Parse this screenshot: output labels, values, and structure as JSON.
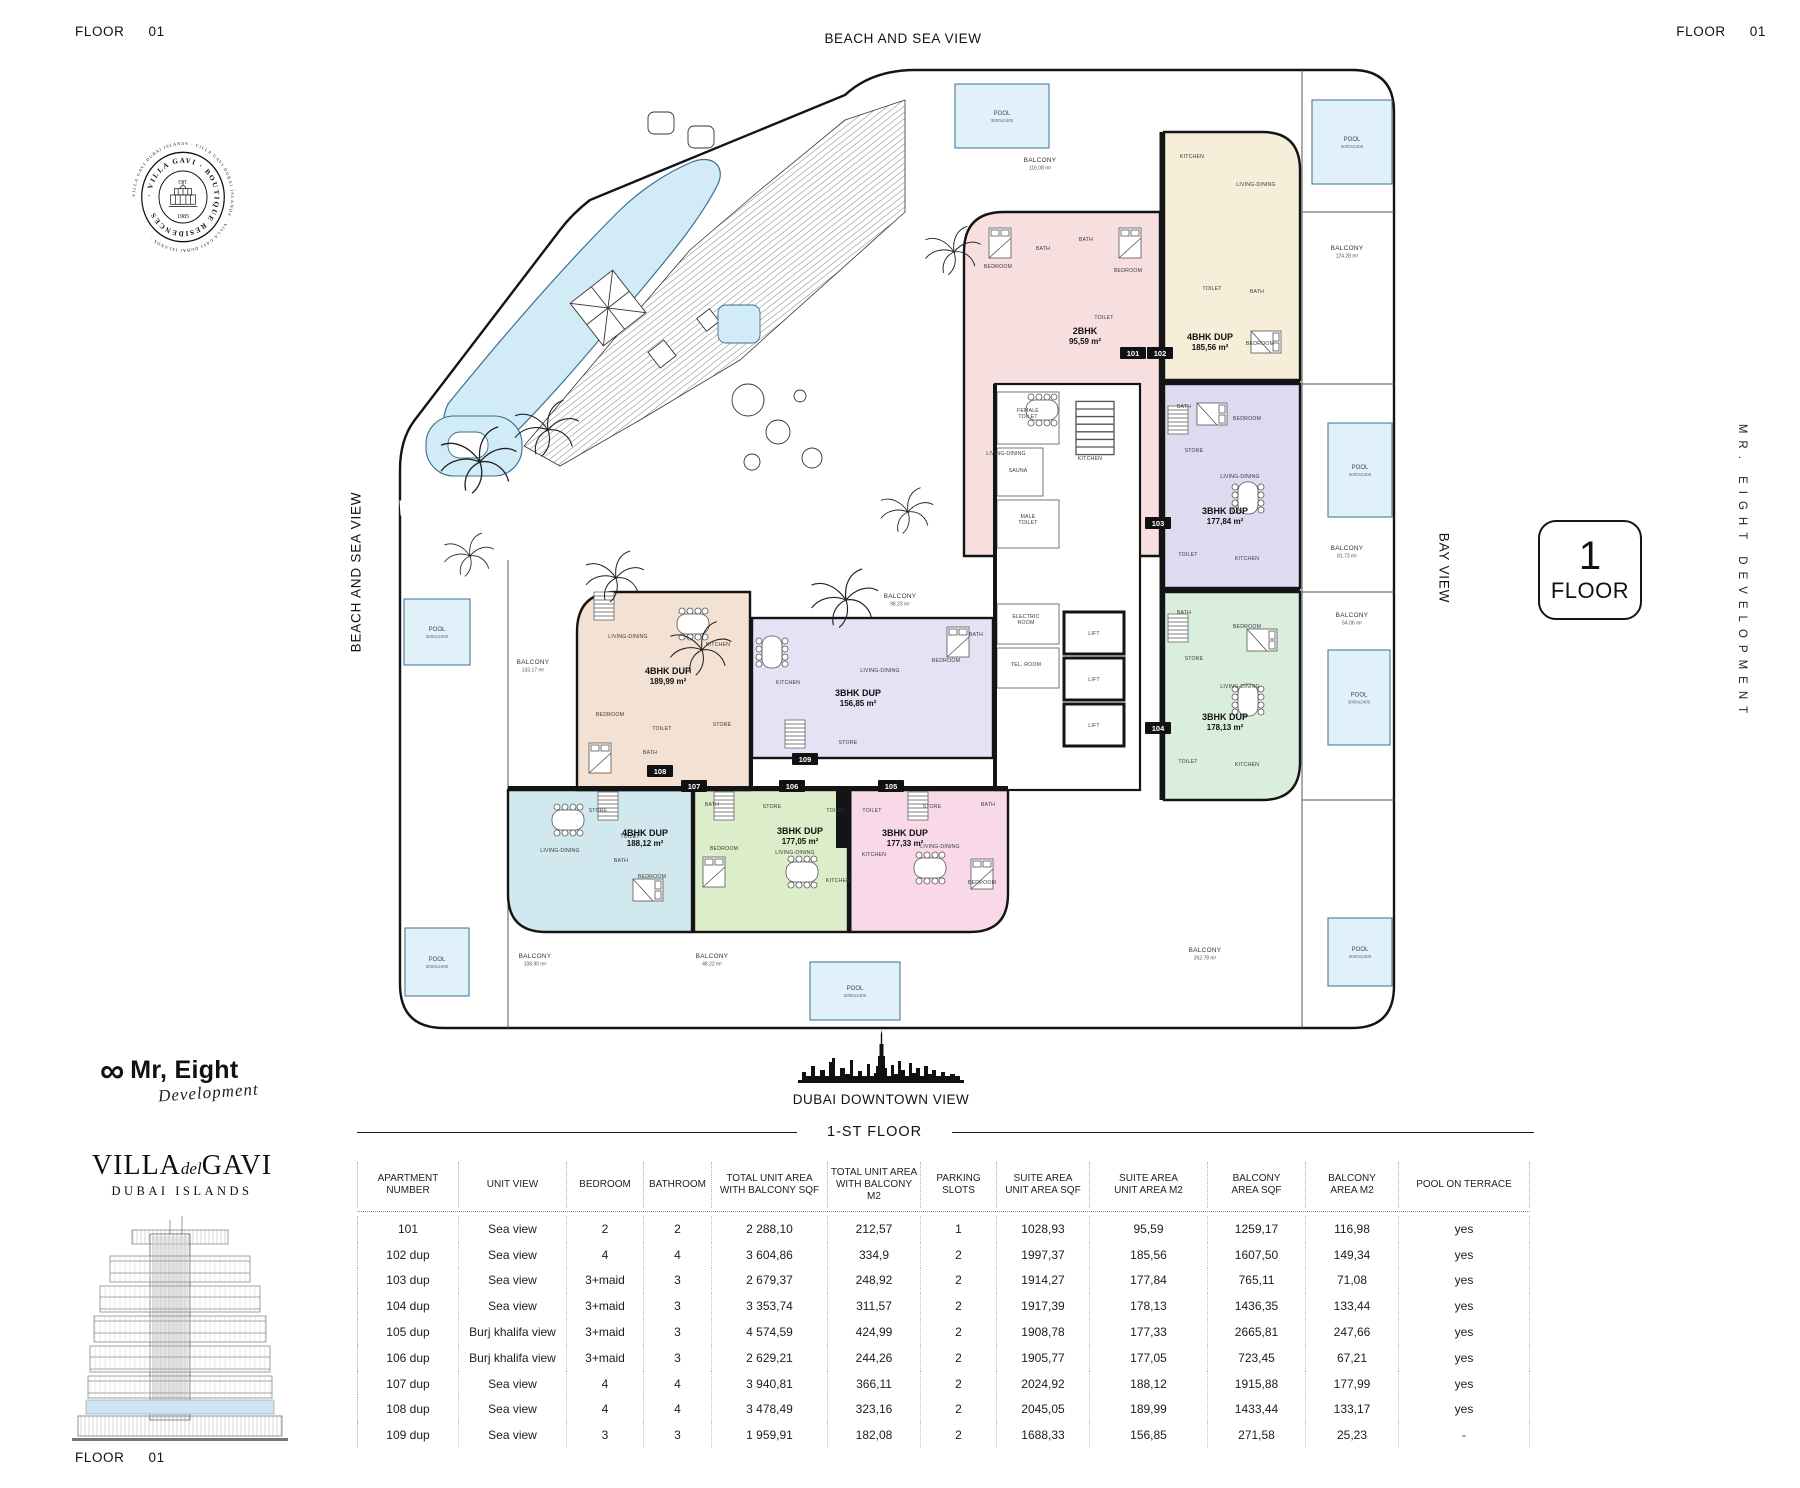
{
  "header": {
    "floor_word": "FLOOR",
    "floor_num": "01",
    "beach_view": "BEACH AND SEA VIEW",
    "bay_view": "BAY VIEW",
    "developer_vertical": "MR. EIGHT DEVELOPMENT",
    "downtown_view": "DUBAI DOWNTOWN VIEW"
  },
  "floor_badge": {
    "number": "1",
    "label": "FLOOR"
  },
  "stamp": {
    "outer_text": "VILLA GAVI DUBAI ISLANDS · VILLA GAVI DUBAI ISLANDS · VILLA GAVI DUBAI ISLANDS · ",
    "ring_text": "· VILLA GAVI ·  BOUTIQUE  RESIDENCES",
    "est": "EST.",
    "year": "1985"
  },
  "logos": {
    "mr_eight": {
      "infinity": "∞",
      "name": "Mr, Eight",
      "script": "Development"
    },
    "villa": {
      "part1": "VILLA",
      "part2": "del",
      "part3": "GAVI",
      "subtitle": "DUBAI ISLANDS"
    }
  },
  "section_title": "1-ST FLOOR",
  "plan": {
    "balcony_word": "BALCONY",
    "pool_word": "POOL",
    "pool_dims": "3000x2400",
    "units": [
      {
        "id": "101",
        "tag": "101",
        "tx": 1133,
        "ty": 353,
        "type": "2BHK",
        "area": "95,59 m²",
        "lx": 1085,
        "ly": 334
      },
      {
        "id": "102",
        "tag": "102",
        "tx": 1160,
        "ty": 353,
        "type": "4BHK DUP",
        "area": "185,56 m²",
        "lx": 1210,
        "ly": 340
      },
      {
        "id": "103",
        "tag": "103",
        "tx": 1158,
        "ty": 523,
        "type": "3BHK DUP",
        "area": "177,84 m²",
        "lx": 1225,
        "ly": 514
      },
      {
        "id": "104",
        "tag": "104",
        "tx": 1158,
        "ty": 728,
        "type": "3BHK DUP",
        "area": "178,13 m²",
        "lx": 1225,
        "ly": 720
      },
      {
        "id": "105",
        "tag": "105",
        "tx": 891,
        "ty": 786,
        "type": "3BHK DUP",
        "area": "177,33 m²",
        "lx": 905,
        "ly": 836
      },
      {
        "id": "106",
        "tag": "106",
        "tx": 792,
        "ty": 786,
        "type": "3BHK DUP",
        "area": "177,05 m²",
        "lx": 800,
        "ly": 834
      },
      {
        "id": "107",
        "tag": "107",
        "tx": 694,
        "ty": 786,
        "type": "4BHK DUP",
        "area": "188,12 m²",
        "lx": 645,
        "ly": 836
      },
      {
        "id": "108",
        "tag": "108",
        "tx": 660,
        "ty": 771,
        "type": "4BHK DUP",
        "area": "189,99 m²",
        "lx": 668,
        "ly": 674
      },
      {
        "id": "109",
        "tag": "109",
        "tx": 805,
        "ty": 759,
        "type": "3BHK DUP",
        "area": "156,85 m²",
        "lx": 858,
        "ly": 696
      }
    ],
    "rooms": [
      {
        "x": 998,
        "y": 268,
        "t": "BEDROOM"
      },
      {
        "x": 1043,
        "y": 250,
        "t": "BATH"
      },
      {
        "x": 1086,
        "y": 241,
        "t": "BATH"
      },
      {
        "x": 1128,
        "y": 272,
        "t": "BEDROOM"
      },
      {
        "x": 1104,
        "y": 319,
        "t": "TOILET"
      },
      {
        "x": 1006,
        "y": 455,
        "t": "LIVING-DINING"
      },
      {
        "x": 1090,
        "y": 460,
        "t": "KITCHEN"
      },
      {
        "x": 1192,
        "y": 158,
        "t": "KITCHEN"
      },
      {
        "x": 1256,
        "y": 186,
        "t": "LIVING-DINING"
      },
      {
        "x": 1212,
        "y": 290,
        "t": "TOILET"
      },
      {
        "x": 1257,
        "y": 293,
        "t": "BATH"
      },
      {
        "x": 1260,
        "y": 345,
        "t": "BEDROOM"
      },
      {
        "x": 1184,
        "y": 408,
        "t": "BATH"
      },
      {
        "x": 1247,
        "y": 420,
        "t": "BEDROOM"
      },
      {
        "x": 1194,
        "y": 452,
        "t": "STORE"
      },
      {
        "x": 1240,
        "y": 478,
        "t": "LIVING-DINING"
      },
      {
        "x": 1188,
        "y": 556,
        "t": "TOILET"
      },
      {
        "x": 1247,
        "y": 560,
        "t": "KITCHEN"
      },
      {
        "x": 1184,
        "y": 614,
        "t": "BATH"
      },
      {
        "x": 1247,
        "y": 628,
        "t": "BEDROOM"
      },
      {
        "x": 1194,
        "y": 660,
        "t": "STORE"
      },
      {
        "x": 1240,
        "y": 688,
        "t": "LIVING-DINING"
      },
      {
        "x": 1188,
        "y": 763,
        "t": "TOILET"
      },
      {
        "x": 1247,
        "y": 766,
        "t": "KITCHEN"
      },
      {
        "x": 872,
        "y": 812,
        "t": "TOILET"
      },
      {
        "x": 932,
        "y": 808,
        "t": "STORE"
      },
      {
        "x": 988,
        "y": 806,
        "t": "BATH"
      },
      {
        "x": 874,
        "y": 856,
        "t": "KITCHEN"
      },
      {
        "x": 940,
        "y": 848,
        "t": "LIVING-DINING"
      },
      {
        "x": 982,
        "y": 884,
        "t": "BEDROOM"
      },
      {
        "x": 712,
        "y": 806,
        "t": "BATH"
      },
      {
        "x": 772,
        "y": 808,
        "t": "STORE"
      },
      {
        "x": 836,
        "y": 812,
        "t": "TOILET"
      },
      {
        "x": 724,
        "y": 850,
        "t": "BEDROOM"
      },
      {
        "x": 795,
        "y": 854,
        "t": "LIVING-DINING"
      },
      {
        "x": 838,
        "y": 882,
        "t": "KITCHEN"
      },
      {
        "x": 598,
        "y": 812,
        "t": "STORE"
      },
      {
        "x": 560,
        "y": 852,
        "t": "LIVING-DINING"
      },
      {
        "x": 630,
        "y": 838,
        "t": "TOILET"
      },
      {
        "x": 621,
        "y": 862,
        "t": "BATH"
      },
      {
        "x": 652,
        "y": 878,
        "t": "BEDROOM"
      },
      {
        "x": 628,
        "y": 638,
        "t": "LIVING-DINING"
      },
      {
        "x": 718,
        "y": 646,
        "t": "KITCHEN"
      },
      {
        "x": 610,
        "y": 716,
        "t": "BEDROOM"
      },
      {
        "x": 662,
        "y": 730,
        "t": "TOILET"
      },
      {
        "x": 650,
        "y": 754,
        "t": "BATH"
      },
      {
        "x": 722,
        "y": 726,
        "t": "STORE"
      },
      {
        "x": 788,
        "y": 684,
        "t": "KITCHEN"
      },
      {
        "x": 880,
        "y": 672,
        "t": "LIVING-DINING"
      },
      {
        "x": 946,
        "y": 662,
        "t": "BEDROOM"
      },
      {
        "x": 976,
        "y": 636,
        "t": "BATH"
      },
      {
        "x": 848,
        "y": 744,
        "t": "STORE"
      },
      {
        "x": 1028,
        "y": 412,
        "t": "FEMALE",
        "t2": "TOILET"
      },
      {
        "x": 1018,
        "y": 472,
        "t": "SAUNA"
      },
      {
        "x": 1028,
        "y": 518,
        "t": "MALE",
        "t2": "TOILET"
      },
      {
        "x": 1026,
        "y": 618,
        "t": "ELECTRIC",
        "t2": "ROOM"
      },
      {
        "x": 1026,
        "y": 666,
        "t": "TEL. ROOM"
      },
      {
        "x": 1094,
        "y": 635,
        "t": "LIFT"
      },
      {
        "x": 1094,
        "y": 681,
        "t": "LIFT"
      },
      {
        "x": 1094,
        "y": 727,
        "t": "LIFT"
      }
    ],
    "balconies": [
      {
        "x": 1040,
        "y": 162,
        "area": "116.08 m²"
      },
      {
        "x": 1347,
        "y": 250,
        "area": "124.28 m²"
      },
      {
        "x": 1347,
        "y": 550,
        "area": "81.73 m²"
      },
      {
        "x": 1352,
        "y": 617,
        "area": "54.06 m²"
      },
      {
        "x": 1205,
        "y": 952,
        "area": "262.78 m²"
      },
      {
        "x": 535,
        "y": 958,
        "area": "108.90 m²"
      },
      {
        "x": 712,
        "y": 958,
        "area": "48.22 m²"
      },
      {
        "x": 900,
        "y": 598,
        "area": "98.23 m²"
      },
      {
        "x": 533,
        "y": 664,
        "area": "133.17 m²"
      }
    ],
    "pools": [
      {
        "x": 955,
        "y": 84,
        "w": 94,
        "h": 64
      },
      {
        "x": 1312,
        "y": 100,
        "w": 80,
        "h": 84
      },
      {
        "x": 1328,
        "y": 423,
        "w": 64,
        "h": 94
      },
      {
        "x": 1328,
        "y": 650,
        "w": 62,
        "h": 95
      },
      {
        "x": 404,
        "y": 599,
        "w": 66,
        "h": 66
      },
      {
        "x": 405,
        "y": 928,
        "w": 64,
        "h": 68
      },
      {
        "x": 810,
        "y": 962,
        "w": 90,
        "h": 58
      },
      {
        "x": 1328,
        "y": 918,
        "w": 64,
        "h": 68
      }
    ]
  },
  "table": {
    "headers": [
      [
        "APARTMENT",
        "NUMBER"
      ],
      [
        "UNIT VIEW"
      ],
      [
        "BEDROOM"
      ],
      [
        "BATHROOM"
      ],
      [
        "TOTAL UNIT AREA",
        "WITH BALCONY SQF"
      ],
      [
        "TOTAL  UNIT AREA",
        "WITH BALCONY M2"
      ],
      [
        "PARKING",
        "SLOTS"
      ],
      [
        "SUITE AREA",
        "UNIT AREA SQF"
      ],
      [
        "SUITE AREA",
        "UNIT AREA M2"
      ],
      [
        "BALCONY",
        "AREA SQF"
      ],
      [
        "BALCONY",
        "AREA M2"
      ],
      [
        "POOL ON TERRACE"
      ]
    ],
    "rows": [
      [
        "101",
        "Sea view",
        "2",
        "2",
        "2 288,10",
        "212,57",
        "1",
        "1028,93",
        "95,59",
        "1259,17",
        "116,98",
        "yes"
      ],
      [
        "102 dup",
        "Sea view",
        "4",
        "4",
        "3 604,86",
        "334,9",
        "2",
        "1997,37",
        "185,56",
        "1607,50",
        "149,34",
        "yes"
      ],
      [
        "103 dup",
        "Sea view",
        "3+maid",
        "3",
        "2 679,37",
        "248,92",
        "2",
        "1914,27",
        "177,84",
        "765,11",
        "71,08",
        "yes"
      ],
      [
        "104 dup",
        "Sea view",
        "3+maid",
        "3",
        "3 353,74",
        "311,57",
        "2",
        "1917,39",
        "178,13",
        "1436,35",
        "133,44",
        "yes"
      ],
      [
        "105 dup",
        "Burj khalifa view",
        "3+maid",
        "3",
        "4 574,59",
        "424,99",
        "2",
        "1908,78",
        "177,33",
        "2665,81",
        "247,66",
        "yes"
      ],
      [
        "106 dup",
        "Burj khalifa view",
        "3+maid",
        "3",
        "2 629,21",
        "244,26",
        "2",
        "1905,77",
        "177,05",
        "723,45",
        "67,21",
        "yes"
      ],
      [
        "107 dup",
        "Sea view",
        "4",
        "4",
        "3 940,81",
        "366,11",
        "2",
        "2024,92",
        "188,12",
        "1915,88",
        "177,99",
        "yes"
      ],
      [
        "108 dup",
        "Sea view",
        "4",
        "4",
        "3 478,49",
        "323,16",
        "2",
        "2045,05",
        "189,99",
        "1433,44",
        "133,17",
        "yes"
      ],
      [
        "109 dup",
        "Sea view",
        "3",
        "3",
        "1 959,91",
        "182,08",
        "2",
        "1688,33",
        "156,85",
        "271,58",
        "25,23",
        "-"
      ]
    ]
  }
}
